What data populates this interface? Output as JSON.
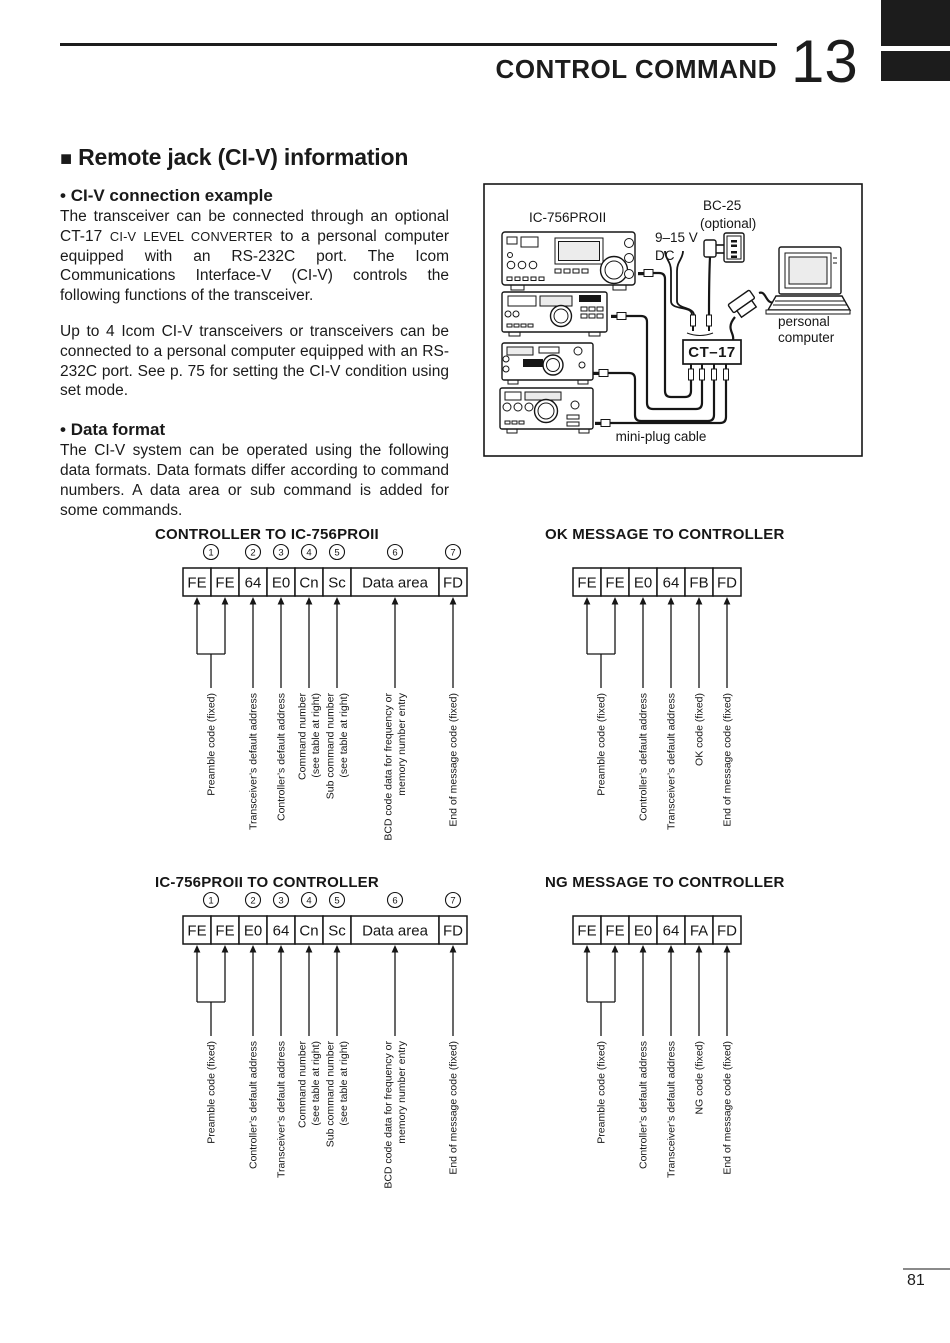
{
  "header": {
    "chapter_title": "CONTROL COMMAND",
    "chapter_number": "13"
  },
  "footer": {
    "page_number": "81"
  },
  "section": {
    "marker": "■",
    "title": "Remote jack (CI-V) information"
  },
  "sub1": {
    "bullet": "•",
    "title": "CI-V connection example",
    "p1a": "The transceiver can be connected through an optional CT-17 ",
    "p1_caps": "CI-V LEVEL CONVERTER",
    "p1b": " to a personal computer equipped with an RS-232C port. The Icom Communications Interface-V (CI-V) controls the following functions of the transceiver.",
    "p2": "Up to 4 Icom CI-V transceivers or transceivers can be connected to a personal computer equipped with an RS-232C port. See p. 75 for setting the CI-V condition using set mode."
  },
  "sub2": {
    "bullet": "•",
    "title": "Data format",
    "p1": "The CI-V system can be operated using the following data formats. Data formats differ according to command numbers. A data area or sub command is added for some commands."
  },
  "connection_diagram": {
    "transceiver_model": "IC-756PROII",
    "power_line1": "9–15 V",
    "power_line2": "DC",
    "bc25_line1": "BC-25",
    "bc25_line2": "(optional)",
    "converter": "CT–17",
    "computer_line1": "personal",
    "computer_line2": "computer",
    "cable_label": "mini-plug cable"
  },
  "format_diagrams": [
    {
      "title": "CONTROLLER TO IC-756PROII",
      "show_numbers": true,
      "cells": [
        "FE",
        "FE",
        "64",
        "E0",
        "Cn",
        "Sc",
        "Data area",
        "FD"
      ],
      "callouts": [
        {
          "number": "1",
          "span": [
            0,
            1
          ],
          "label": [
            "Preamble code (fixed)"
          ]
        },
        {
          "number": "2",
          "span": [
            2,
            2
          ],
          "label": [
            "Transceiver’s default address"
          ]
        },
        {
          "number": "3",
          "span": [
            3,
            3
          ],
          "label": [
            "Controller’s default address"
          ]
        },
        {
          "number": "4",
          "span": [
            4,
            4
          ],
          "label": [
            "Command number",
            "(see table at right)"
          ]
        },
        {
          "number": "5",
          "span": [
            5,
            5
          ],
          "label": [
            "Sub command number",
            "(see table at right)"
          ]
        },
        {
          "number": "6",
          "span": [
            6,
            6
          ],
          "label": [
            "BCD code data for frequency or",
            "memory number entry"
          ]
        },
        {
          "number": "7",
          "span": [
            7,
            7
          ],
          "label": [
            "End of message code (fixed)"
          ]
        }
      ]
    },
    {
      "title": "OK MESSAGE TO CONTROLLER",
      "show_numbers": false,
      "cells": [
        "FE",
        "FE",
        "E0",
        "64",
        "FB",
        "FD"
      ],
      "callouts": [
        {
          "span": [
            0,
            1
          ],
          "label": [
            "Preamble code (fixed)"
          ]
        },
        {
          "span": [
            2,
            2
          ],
          "label": [
            "Controller’s default address"
          ]
        },
        {
          "span": [
            3,
            3
          ],
          "label": [
            "Transceiver’s default address"
          ]
        },
        {
          "span": [
            4,
            4
          ],
          "label": [
            "OK code (fixed)"
          ]
        },
        {
          "span": [
            5,
            5
          ],
          "label": [
            "End of message code (fixed)"
          ]
        }
      ]
    },
    {
      "title": "IC-756PROII TO CONTROLLER",
      "show_numbers": true,
      "cells": [
        "FE",
        "FE",
        "E0",
        "64",
        "Cn",
        "Sc",
        "Data area",
        "FD"
      ],
      "callouts": [
        {
          "number": "1",
          "span": [
            0,
            1
          ],
          "label": [
            "Preamble code (fixed)"
          ]
        },
        {
          "number": "2",
          "span": [
            2,
            2
          ],
          "label": [
            "Controller’s default address"
          ]
        },
        {
          "number": "3",
          "span": [
            3,
            3
          ],
          "label": [
            "Transceiver’s default address"
          ]
        },
        {
          "number": "4",
          "span": [
            4,
            4
          ],
          "label": [
            "Command number",
            "(see table at right)"
          ]
        },
        {
          "number": "5",
          "span": [
            5,
            5
          ],
          "label": [
            "Sub command number",
            "(see table at right)"
          ]
        },
        {
          "number": "6",
          "span": [
            6,
            6
          ],
          "label": [
            "BCD code data for frequency or",
            "memory number entry"
          ]
        },
        {
          "number": "7",
          "span": [
            7,
            7
          ],
          "label": [
            "End of message code (fixed)"
          ]
        }
      ]
    },
    {
      "title": "NG MESSAGE TO CONTROLLER",
      "show_numbers": false,
      "cells": [
        "FE",
        "FE",
        "E0",
        "64",
        "FA",
        "FD"
      ],
      "callouts": [
        {
          "span": [
            0,
            1
          ],
          "label": [
            "Preamble code (fixed)"
          ]
        },
        {
          "span": [
            2,
            2
          ],
          "label": [
            "Controller’s default address"
          ]
        },
        {
          "span": [
            3,
            3
          ],
          "label": [
            "Transceiver’s default address"
          ]
        },
        {
          "span": [
            4,
            4
          ],
          "label": [
            "NG code (fixed)"
          ]
        },
        {
          "span": [
            5,
            5
          ],
          "label": [
            "End of message code (fixed)"
          ]
        }
      ]
    }
  ]
}
